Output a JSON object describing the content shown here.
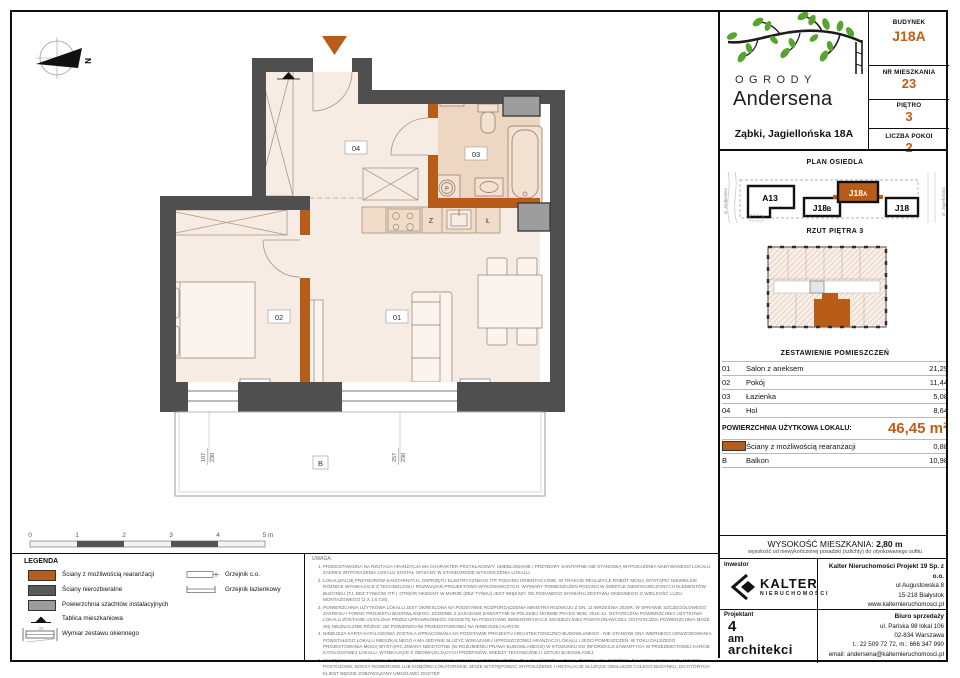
{
  "colors": {
    "accent": "#b85c1a",
    "accent_text": "#c25d15",
    "wall": "#4f4f4f",
    "shaft": "#9d9d9d",
    "floor": "#f7ece4",
    "bath_floor": "#eed7c2"
  },
  "header": {
    "logo_line1": "OGRODY",
    "logo_line2": "Andersena",
    "address": "Ząbki, Jagiellońska 18A",
    "info": [
      {
        "label": "BUDYNEK",
        "value": "J18A"
      },
      {
        "label": "NR MIESZKANIA",
        "value": "23"
      },
      {
        "label": "PIĘTRO",
        "value": "3"
      },
      {
        "label": "LICZBA POKOI",
        "value": "2"
      }
    ]
  },
  "site_plan": {
    "title": "PLAN OSIEDLA",
    "street_left": "ul. Andersena",
    "street_right": "ul. Jagiellońska",
    "buildings": {
      "a13": "A13",
      "j18b": {
        "main": "J18",
        "sub": "B"
      },
      "j18a": {
        "main": "J18",
        "sub": "A"
      },
      "j18": "J18"
    }
  },
  "floor_overview": {
    "title": "RZUT PIĘTRA 3"
  },
  "rooms_table": {
    "title": "ZESTAWIENIE POMIESZCZEŃ",
    "rows": [
      {
        "no": "01",
        "name": "Salon z aneksem",
        "area": "21,29"
      },
      {
        "no": "02",
        "name": "Pokój",
        "area": "11,44"
      },
      {
        "no": "03",
        "name": "Łazienka",
        "area": "5,08"
      },
      {
        "no": "04",
        "name": "Hol",
        "area": "8,64"
      }
    ],
    "total_label": "POWIERZCHNIA UŻYTKOWA LOKALU:",
    "total_value": "46,45 m²",
    "walls_row": {
      "name": "Ściany z możliwością rearanżacji",
      "area": "0,88"
    },
    "balcony_row": {
      "no": "B",
      "name": "Balkon",
      "area": "10,98"
    }
  },
  "height_info": {
    "label": "WYSOKOŚĆ MIESZKANIA:",
    "value": "2,80 m",
    "note": "wysokość od niewykończonej posadzki (szlichty) do otynkowanego sufitu"
  },
  "investor": {
    "label": "Inwestor",
    "brand": "KALTER",
    "brand_sub": "NIERUCHOMOŚCI",
    "company": "Kalter Nieruchomości Projekt 19 Sp. z o.o.",
    "address1": "ul Augustowska 8",
    "address2": "15-218 Białystok",
    "website": "www.kalternieruchomosci.pl"
  },
  "designer": {
    "label": "Projektant",
    "logo_l1": "4",
    "logo_l2": "am",
    "logo_l3": "architekci",
    "office": "Biuro sprzedaży",
    "address1": "ul. Pańska 98 lokal 106",
    "address2": "02-834 Warszawa",
    "phone": "t.: 22 509 72 72, m.: 666 347 990",
    "email": "email: andersena@kalternieruchomosci.pl"
  },
  "legend": {
    "title": "LEGENDA",
    "items": [
      {
        "label": "Ściany z możliwością rearanżacji"
      },
      {
        "label": "Ściany nierozbieralne"
      },
      {
        "label": "Powierzchnia szachtów instalacyjnych"
      },
      {
        "label": "Tablica mieszkaniowa"
      },
      {
        "label": "Wymiar zestawu okiennego"
      }
    ],
    "radiators": [
      {
        "label": "Grzejnik c.o."
      },
      {
        "label": "Grzejnik łazienkowy"
      }
    ]
  },
  "notes": {
    "title": "UWAGA:",
    "items": [
      "PRZEDSTAWIONA NA RZUTACH ARANŻACJA MA CHARAKTER PRZYKŁADOWY. UMEBLOWANIE I PRZYBORY SANITARNE NIE STANOWIĄ WYPOSAŻENIA NABYWANEGO LOKALU. ZAKRES WYPOSAŻENIA LOKALU ZOSTAŁ OPISANY W STANDARDZIE WYKOŃCZENIA LOKALU.",
      "LOKALIZACJĘ PRZYBORÓW SANITARNYCH, OSPRZĘTU ELEKTRYCZNEGO ITP. PODANO ORIENTACYJNIE. W TRAKCIE REALIZACJI ROBÓT MOGĄ WYSTĄPIĆ NIEWIELKIE RÓŻNICE WYNIKAJĄCE Z TECHNOLOGII I ROZWIĄZAŃ PROJEKTOWO-WYKONAWCZYCH. WYMIARY POMIESZCZEŃ PODANO W ŚWIETLE NIEWYKOŃCZONYCH ELEMENTÓW BUDYNKU (TJ. BEZ TYNKÓW ITP.). OTWÓR OKIENNY W MURZE (BEZ TYNKU) JEST WIĘKSZY OD PODANEGO WYMIARU ZESTAWU OKIENNEGO O WIELKOŚĆ LUZU MONTAŻOWEGO (2 X 1,5 CM).",
      "POWIERZCHNIA UŻYTKOWA LOKALU JEST OKREŚLONA NA PODSTAWIE ROZPORZĄDZENIA MINISTRA ROZWOJU Z DN. 11 WRZEŚNIA 2020R. W SPRAWIE SZCZEGÓŁOWEGO ZAKRESU I FORMY PROJEKTU BUDOWLANEGO, ZGODNIE Z ZASADAMI ZAWARTYMI W POLSKIEJ NORMIE PN-ISO 9836: 2015-12. OSTATECZNA POWIERZCHNIA UŻYTKOWA LOKALU ZOSTANIE USTALONA PRZEZ UPRAWNIONEGO GEODETĘ NA PODSTAWIE INWENTARYZACJI GEODEZYJNEJ POWYKONAWCZEJ. OSTATECZNA POWIERZCHNIA MOŻE SIĘ NIEZNACZNIE RÓŻNIĆ OD POWIERZCHNI PRZEDSTAWIONEJ NA NINIEJSZEJ KARCIE.",
      "NINIEJSZA KARTA KATALOGOWA ZOSTAŁA OPRACOWANA NA PODSTAWIE PROJEKTU ARCHITEKTONICZNO-BUDOWLANEGO - NIE STANOWI ONA WIERNEGO ODWZOROWANIA POWSTAŁEGO LOKALU MIESZKALNEGO A MA JEDYNIE SŁUŻYĆ WSKAZANIU UPROSZCZONEJ ARANŻACJI LOKALU I JEGO POMIESZCZEŃ. W TOKU DALSZEGO PROJEKTOWANIA MOGĄ WYSTĄPIĆ ZMIANY NIEISTOTNE (W ROZUMIENIU PRAWA BUDOWLANEGO) W STOSUNKU DO INFORMACJI ZAWARTYCH W PRZEDMIOTOWEJ KARCIE KATALOGOWEJ LOKALU, WYNIKAJĄCE Z OBOWIĄZUJĄCYCH PRZEPISÓW, WIEDZY TECHNICZNEJ I SZTUKI BUDOWLANEJ.",
      "W CZĘŚCIACH WSPÓLNYCH BUDYNKU, PRZEWIDYWANYCH DO WYŁĄCZNEGO UŻYTKU DLA WŁAŚCICIELI LOKALI, TAKICH JAK: OGRÓDKI, BALKONY, ELEWACJE, MIEJSCA POSTOJOWE, BOKSY ROWEROWE LUB KOMÓRKI LOKATORSKIE, MOŻE WYSTĘPOWAĆ WYPOSAŻENIE I INSTALACJE SŁUŻĄCE OBSŁUDZE CAŁEGO BUDYNKU, DO KTÓRYCH KLIENT BĘDZIE ZOBOWIĄZANY UMOŻLIWIĆ DOSTĘP.",
      "NINIEJSZA KARTA NIE PRZEDSTAWIA KOMPLETNEGO PROJEKTU WIELOBRANŻOWEGO. RYSUNEK NIE JEST PRZEZNACZONY DO CELÓW WYKONAWCZYCH. SZCZEGÓŁOWE INFORMACJE PROJEKTOWE ZNAJDUJĄ SIĘ W DOKUMENTACJI TECHNICZNO-WYKONAWCZEJ DOSTĘPNEJ DO WGLĄDU DLA KLIENTÓW W BIURZE INWESTORA.",
      "PROJEKT CHRONIONY PRAWEM AUTORSKIM."
    ]
  },
  "plan": {
    "labels": {
      "north": "N",
      "r01": "01",
      "r02": "02",
      "r03": "03",
      "r04": "04",
      "balcony": "B",
      "sink_z": "Z",
      "fridge": "Ł",
      "washer": "P"
    },
    "dims": {
      "d1w": "107",
      "d1h": "230",
      "d2w": "257",
      "d2h": "230"
    },
    "scale": [
      "0",
      "1",
      "2",
      "3",
      "4",
      "5 m"
    ]
  }
}
